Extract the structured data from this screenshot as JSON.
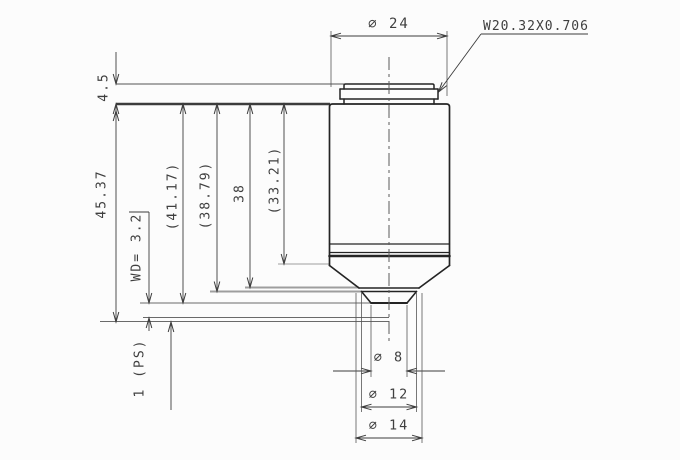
{
  "colors": {
    "background": "#fcfcfc",
    "object_line": "#242424",
    "dimension_line": "#3c3c3c",
    "reference_line_gray": "#9e9e9e",
    "text": "#3f3f3f"
  },
  "labels": {
    "top_diameter": "∅ 24",
    "thread_spec": "W20.32X0.706",
    "cap_height": "4.5",
    "parfocal_length": "45.37",
    "working_distance": "WD= 3.2",
    "ref_41_17": "(41.17)",
    "ref_38_79": "(38.79)",
    "ref_38": "38",
    "ref_33_21": "(33.21)",
    "slide_ref": "1 (PS)",
    "tip_diameter": "∅ 8",
    "mid_diameter": "∅ 12",
    "nose_diameter": "∅ 14"
  }
}
